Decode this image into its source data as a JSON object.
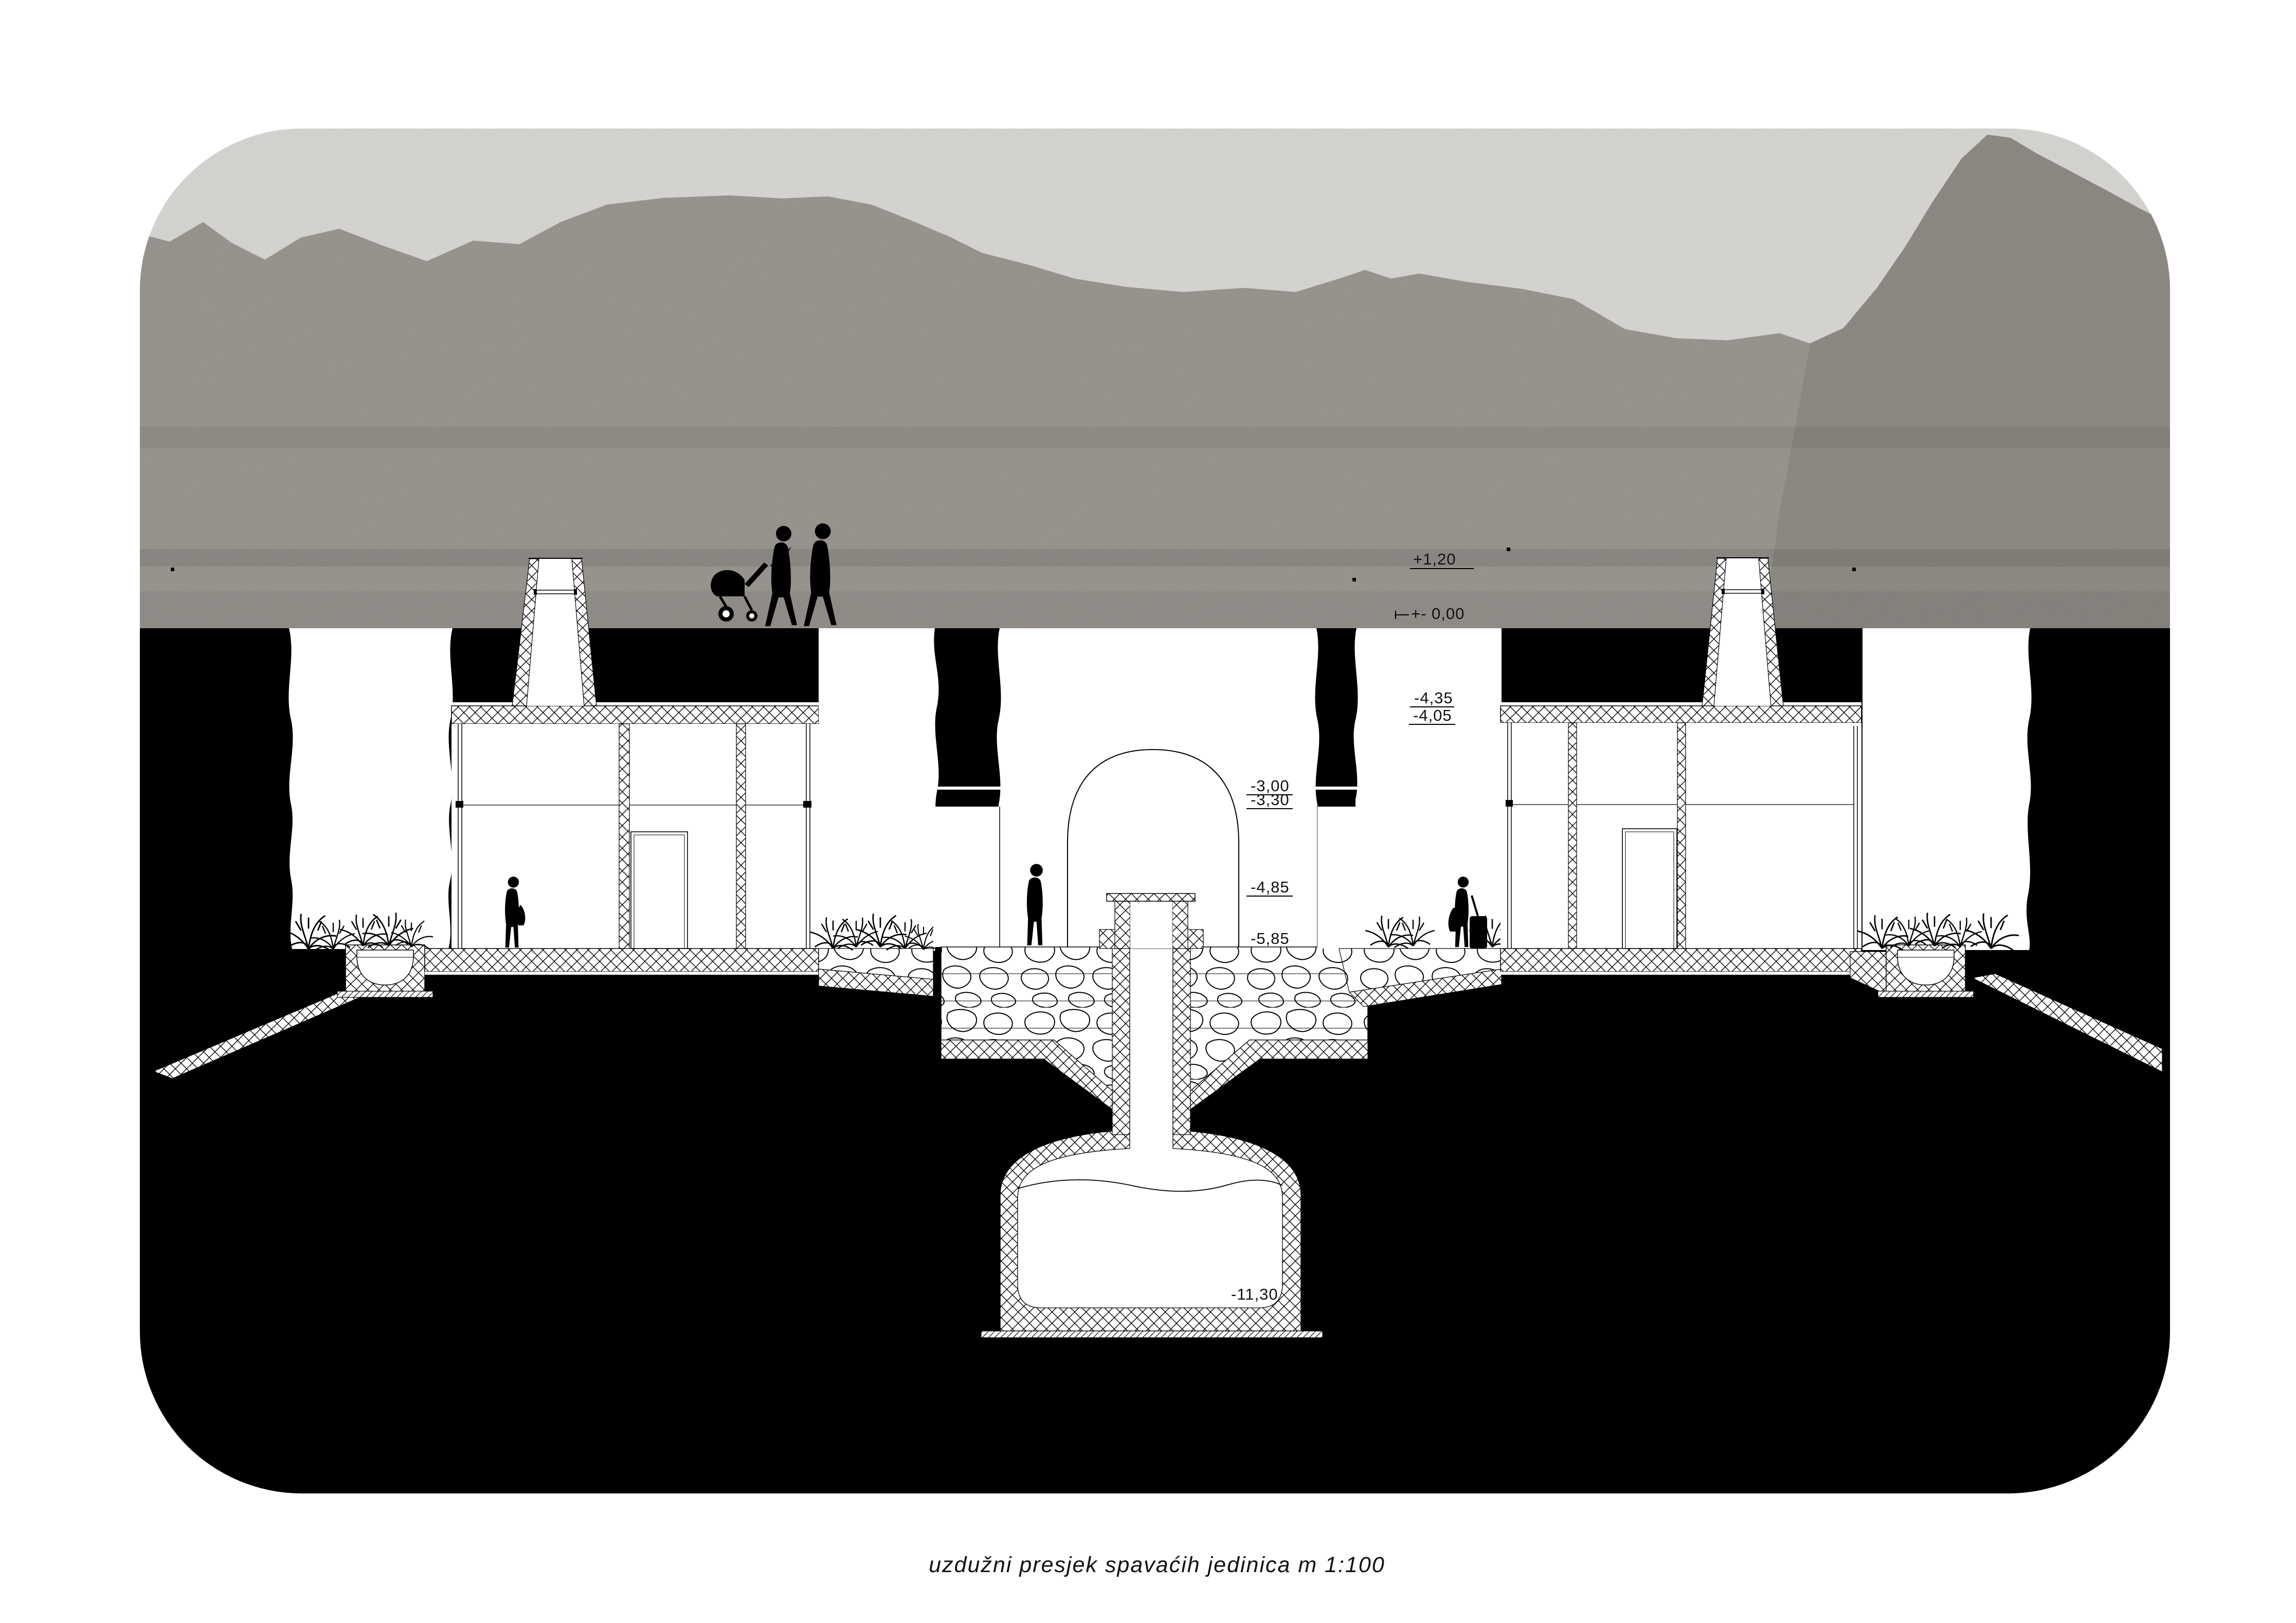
{
  "drawing": {
    "caption": "uzdužni presjek spavaćih jedinica m 1:100",
    "levels": {
      "plus120": "+1,20",
      "zero": "+- 0,00",
      "m435": "-4,35",
      "m405": "-4,05",
      "m300": "-3,00",
      "m330": "-3,30",
      "m485": "-4,85",
      "m585": "-5,85",
      "m1130": "-11,30"
    },
    "colors": {
      "paper": "#ffffff",
      "ink": "#000000",
      "earth": "#000000",
      "sky": "#d7d6d2",
      "rock": "#908b84",
      "rock_shade": "#837e77"
    }
  }
}
